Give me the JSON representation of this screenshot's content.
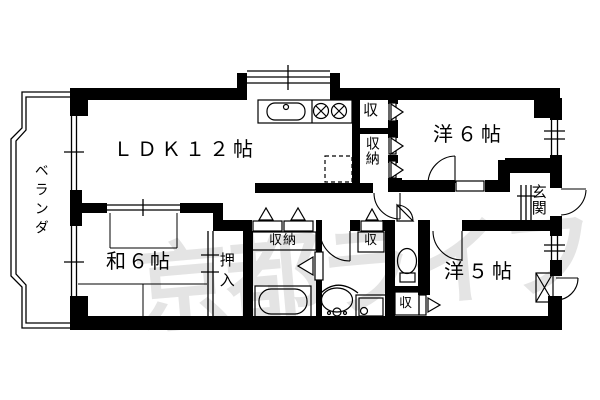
{
  "floorplan": {
    "watermark": "京都ライフ",
    "rooms": {
      "ldk": "ＬＤＫ１２帖",
      "western6": "洋６帖",
      "japanese6": "和６帖",
      "western5": "洋５帖",
      "veranda": "ベランダ",
      "entrance": "玄関",
      "oshiire": "押入",
      "storage_kitchen_top": "収",
      "storage_kitchen_bottom": "収納",
      "storage_hall_wide": "収納",
      "storage_hall_small": "収",
      "storage_toilet": "収"
    },
    "colors": {
      "line": "#000000",
      "background": "#ffffff",
      "watermark": "#e4e4e4"
    }
  }
}
